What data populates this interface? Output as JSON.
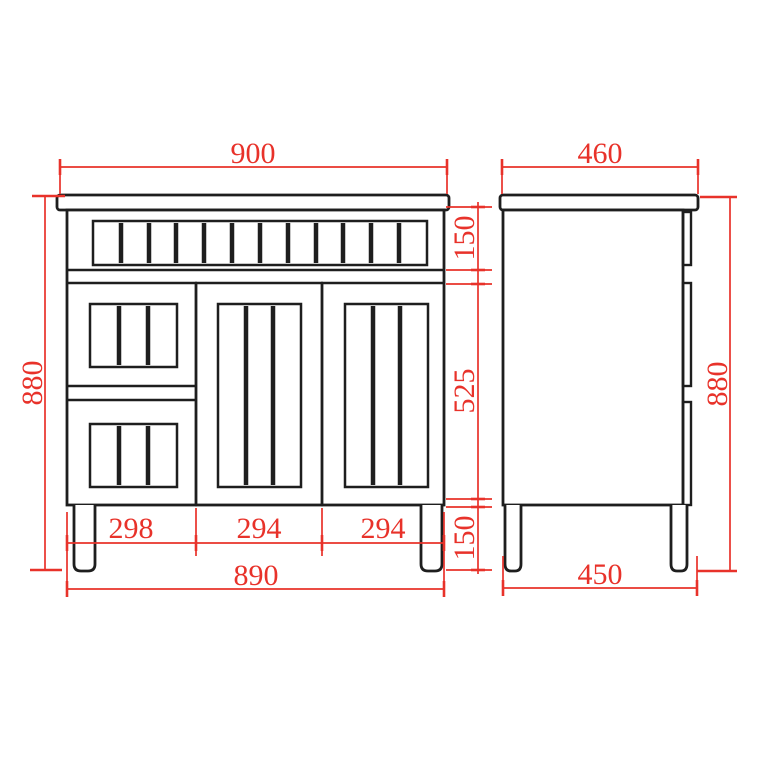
{
  "drawing": {
    "colors": {
      "dimension_red": "#e8322a",
      "line_dark": "#1e1e1e",
      "background": "#ffffff"
    },
    "front_view": {
      "dim_overall_width_top": "900",
      "dim_overall_height_left": "880",
      "dim_top_drawer_height": "150",
      "dim_middle_section_height": "525",
      "dim_leg_height": "150",
      "dim_left_drawer_width": "298",
      "dim_center_door_width": "294",
      "dim_right_door_width": "294",
      "dim_carcass_width_bottom": "890"
    },
    "side_view": {
      "dim_overall_depth_top": "460",
      "dim_overall_height_right": "880",
      "dim_carcass_depth_bottom": "450"
    }
  }
}
